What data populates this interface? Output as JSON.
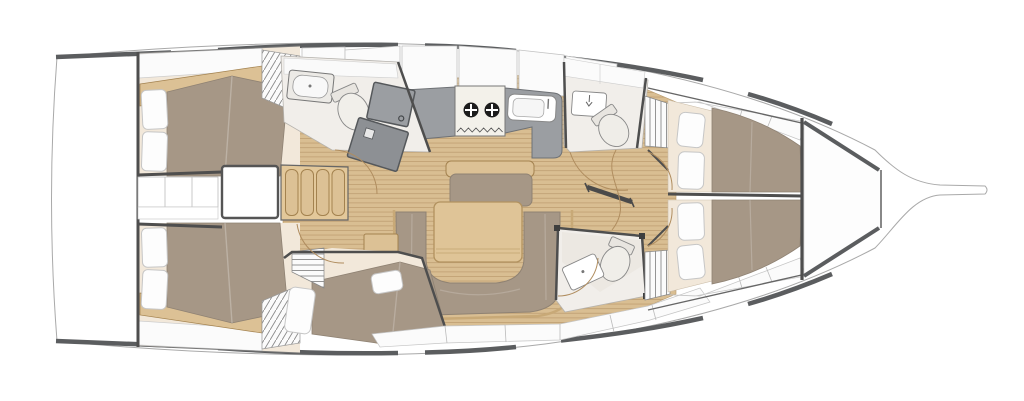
{
  "colors": {
    "page_bg": "#ffffff",
    "hull_outline": "#a9a9a9",
    "deck_rail": "#5b5d5f",
    "bulkhead": "#4e4e4e",
    "wood_floor": "#d9be92",
    "wood_plank_line": "#c2a376",
    "wood_trim": "#dcc195",
    "wood_trim_border": "#a3824f",
    "upholstery": "#a69786",
    "upholstery_border": "#8f8273",
    "mattress_cream": "#f2e8da",
    "pillow": "#fdfdfd",
    "pillow_border": "#c6c6c6",
    "counter_gray": "#9b9ea2",
    "counter_border": "#6e7175",
    "shower_gray": "#8d9094",
    "shower_border": "#55585b",
    "head_floor": "#f1eeea",
    "fixture_white": "#ffffff",
    "fixture_border": "#888888",
    "locker_white": "#fbfbfb",
    "locker_border": "#c2c2c2",
    "door_arc": "#b08d5f",
    "table_wood": "#dfc497",
    "stove_panel": "#f3f1ea",
    "stove_burner": "#1c1c1c"
  },
  "icons": {
    "stove_burner_icon": "black-circle-with-white-cross",
    "faucet_icon": "down-arrow-tap",
    "shower_drain_icon": "small-square",
    "hatch_vertical_icon": "vertical-line-hatch",
    "hatch_diagonal_icon": "diagonal-line-hatch",
    "hatch_shelf_icon": "horizontal-line-hatch"
  }
}
